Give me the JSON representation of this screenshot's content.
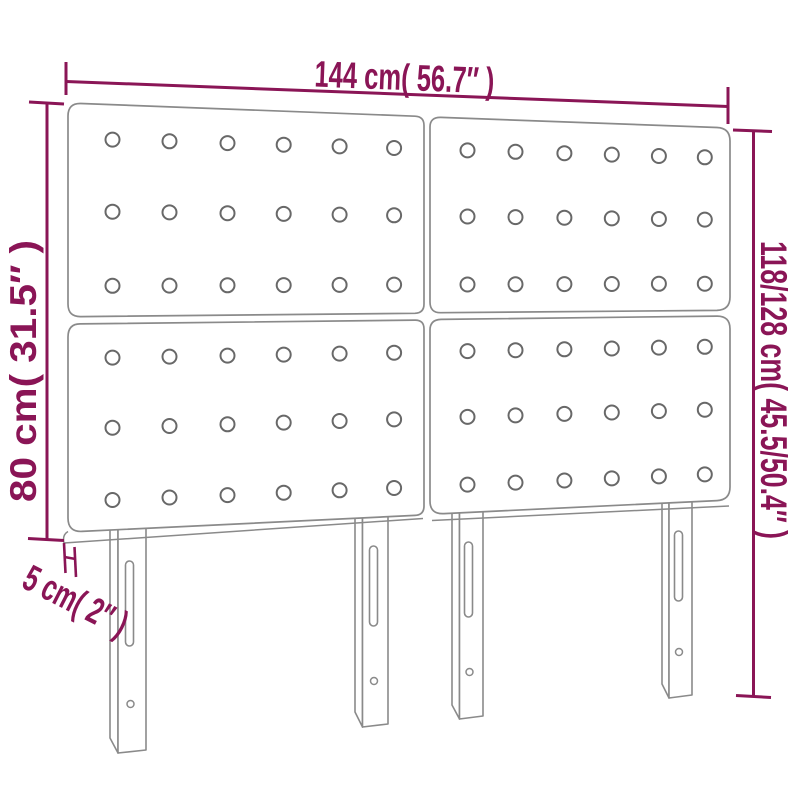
{
  "diagram": {
    "name": "upholstered-headboard-dimension-diagram",
    "labels": {
      "width": "144 cm( 56.7″ )",
      "panel_height": "80 cm( 31.5″ )",
      "total_height": "118/128 cm( 45.5/50.4″ )",
      "thickness": "5 cm( 2″ )"
    },
    "colors": {
      "dimension": "#8a1556",
      "outline": "#8a8a8a",
      "button_outline": "#686868",
      "background": "#ffffff"
    },
    "structure": {
      "panel_count": 4,
      "button_rows_per_panel": 3,
      "button_cols_per_panel": 6,
      "leg_count": 4
    }
  }
}
